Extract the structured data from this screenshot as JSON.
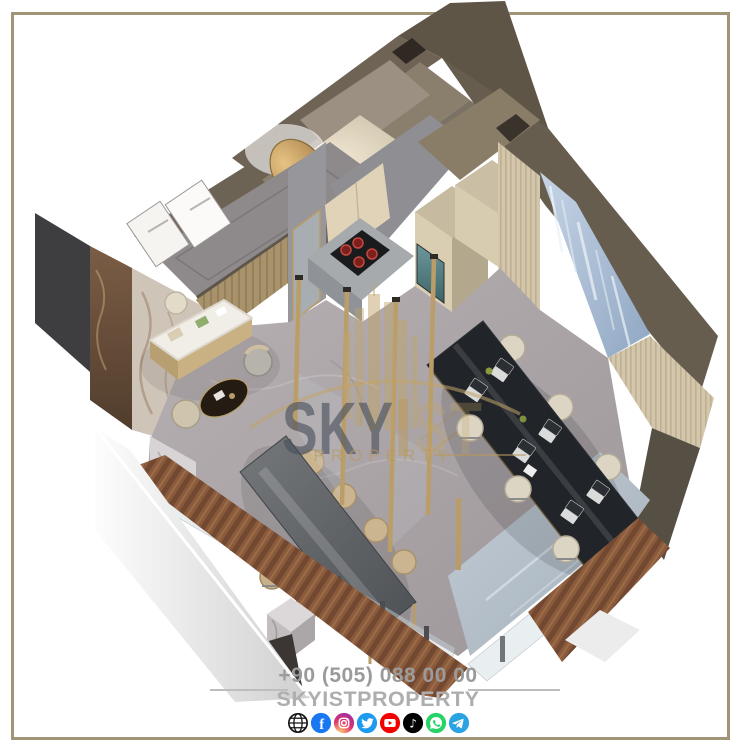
{
  "frame": {
    "color": "#a29477"
  },
  "watermark": {
    "text_dark": "SKY",
    "text_light": "ST",
    "subtitle": "PROPERTY",
    "gold": "#c3a572",
    "dark": "#4a4f58"
  },
  "footer": {
    "phone": "+90 (505) 088 00 00",
    "brand": "SKYISTPROPERTY",
    "text_color": "#a3a3a3",
    "social_icons": [
      {
        "name": "website-globe",
        "color": "#141414"
      },
      {
        "name": "facebook",
        "color": "#1877f2",
        "glyph": "f"
      },
      {
        "name": "instagram",
        "color": "#d62976"
      },
      {
        "name": "twitter",
        "color": "#1d9bf0"
      },
      {
        "name": "youtube",
        "color": "#f30000"
      },
      {
        "name": "tiktok",
        "color": "#010101",
        "glyph": "♪"
      },
      {
        "name": "whatsapp",
        "color": "#25d366"
      },
      {
        "name": "telegram",
        "color": "#2aa3e3"
      }
    ]
  },
  "scene": {
    "type": "isometric-3d-office-interior-render",
    "palette": {
      "wall_taupe": "#6b6153",
      "wall_gray": "#8e898a",
      "floor_marble_gray": "#aaa4a6",
      "floor_marble_blue": "#b3bec8",
      "wood_deck": "#8a5a3c",
      "cabinet_cream": "#dccfb4",
      "table_black": "#23262a",
      "chair_cream": "#d9d1c0",
      "chair_tan": "#c8b28c",
      "accent_gold": "#b99c68",
      "blue_marble_wall": "#aec2d8",
      "glass": "#c9d4da"
    }
  }
}
